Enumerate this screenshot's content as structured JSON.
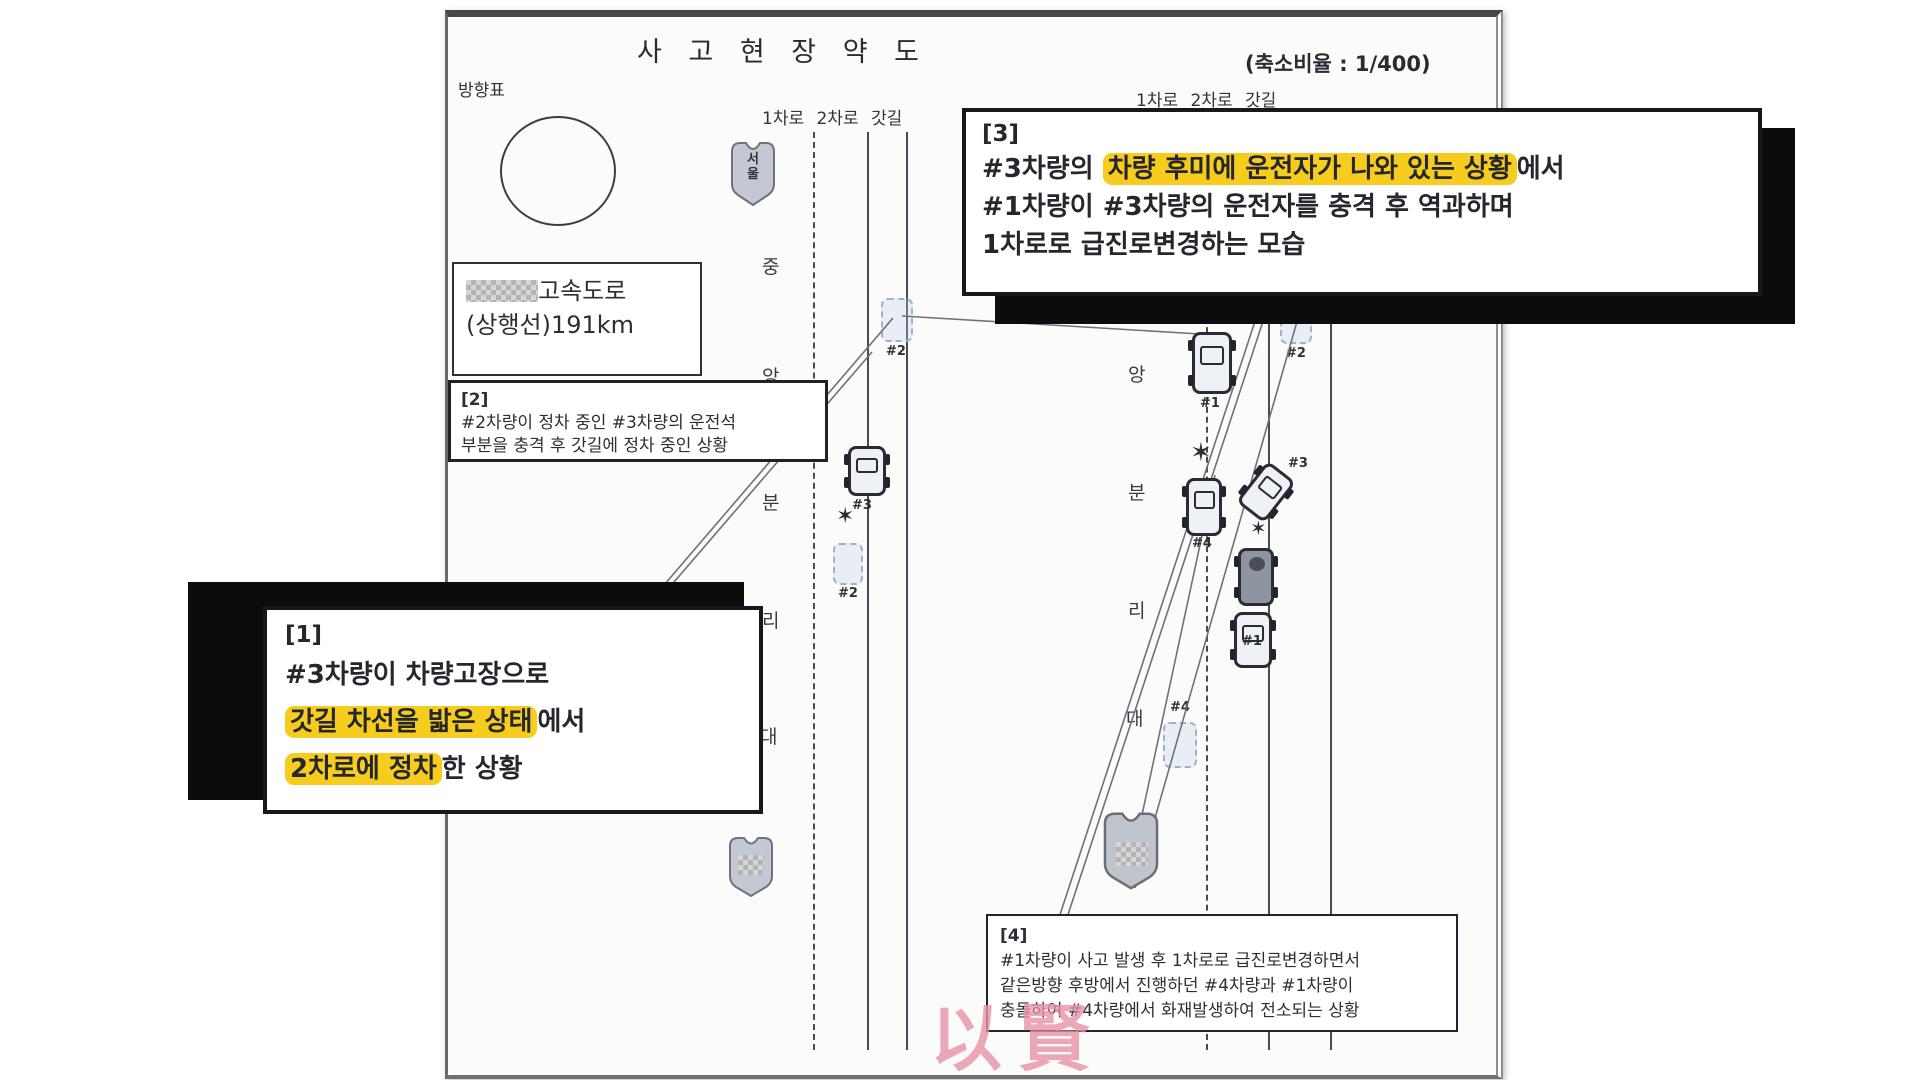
{
  "document": {
    "title": "사 고 현 장 약 도",
    "scale_note": "(축소비율 : 1/400)",
    "direction_label": "방향표",
    "location_box": {
      "line1": "고속도로",
      "line2": "(상행선)191km"
    },
    "watermark": "以賢"
  },
  "roads": {
    "left": {
      "lane_label": "1차로 2차로 갓길",
      "median": [
        "중",
        "앙",
        "분",
        "리",
        "대"
      ]
    },
    "right": {
      "lane_label": "1차로 2차로 갓길",
      "median": [
        "앙",
        "분",
        "리",
        "대"
      ]
    },
    "shield_seoul": {
      "char1": "서",
      "char2": "울"
    }
  },
  "callouts": {
    "box1": {
      "tag": "[1]",
      "line1": "#3차량이 차량고장으로",
      "line2_hl": "갓길 차선을 밟은 상태",
      "line2_rest": "에서",
      "line3_hl": "2차로에 정차",
      "line3_rest": "한 상황"
    },
    "box2": {
      "tag": "[2]",
      "line1": "#2차량이 정차 중인 #3차량의 운전석",
      "line2": "부분을 충격 후 갓길에 정차 중인 상황"
    },
    "box3": {
      "tag": "[3]",
      "line1_pre": "#3차량의 ",
      "line1_hl": "차량 후미에 운전자가 나와 있는 상황",
      "line1_rest": "에서",
      "line2": "#1차량이 #3차량의 운전자를 충격 후 역과하며",
      "line3": "1차로로 급진로변경하는 모습"
    },
    "box4": {
      "tag": "[4]",
      "line1": "#1차량이 사고 발생 후 1차로로 급진로변경하면서",
      "line2": "같은방향 후방에서 진행하던 #4차량과 #1차량이",
      "line3": "충돌하여 #4차량에서 화재발생하여 전소되는 상황"
    }
  },
  "cars": {
    "left_ghost_top": "#2",
    "left_solid": "#3",
    "left_ghost_bottom": "#2",
    "right_ghost_top": "#2",
    "right_truck": "#1",
    "right_car4": "#4",
    "right_car3": "#3",
    "right_car1": "#1",
    "right_ghost4": "#4"
  },
  "icons": {
    "burst": "✶"
  },
  "colors": {
    "highlight": "#f6cd1e",
    "watermark_pink": "#e893a8",
    "ghost_car": "#9fb2cc",
    "ink": "#32323e",
    "callout_border": "#17171d"
  }
}
